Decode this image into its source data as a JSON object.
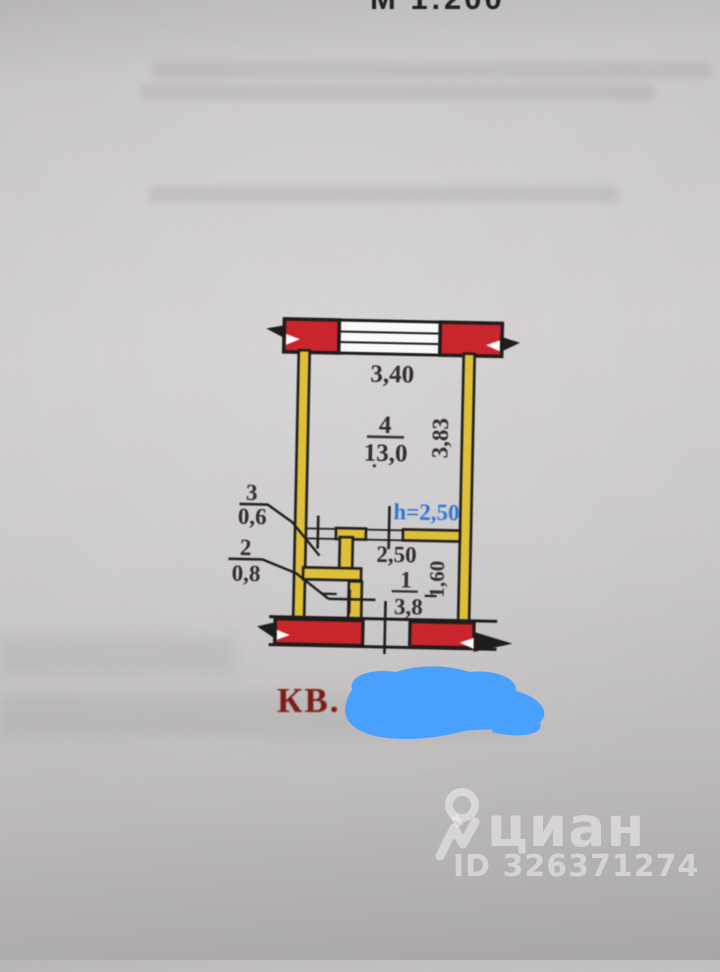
{
  "page": {
    "scale_label": "М 1:200",
    "apartment_label": "КВ."
  },
  "plan": {
    "dim_top": "3,40",
    "dim_right": "3,83",
    "room4_num": "4",
    "room4_area": "13,0",
    "height_note": "h=2,50",
    "dim_hall": "2,50",
    "dim_hall_right": "1,60",
    "room1_num": "1",
    "room1_area": "3,8",
    "room3_num": "3",
    "room3_area": "0,6",
    "room2_num": "2",
    "room2_area": "0,8"
  },
  "watermark": {
    "brand": "циан",
    "listing_id": "ID 326371274"
  },
  "colors": {
    "wall_red": "#c9252c",
    "wall_yellow": "#ddbf3a",
    "outline_black": "#1f1d1c",
    "blue_note": "#2f78d8",
    "kv_red": "#7a1d15",
    "scribble_blue": "#4aa0fd",
    "paper_gray": "#c9c6c7"
  }
}
